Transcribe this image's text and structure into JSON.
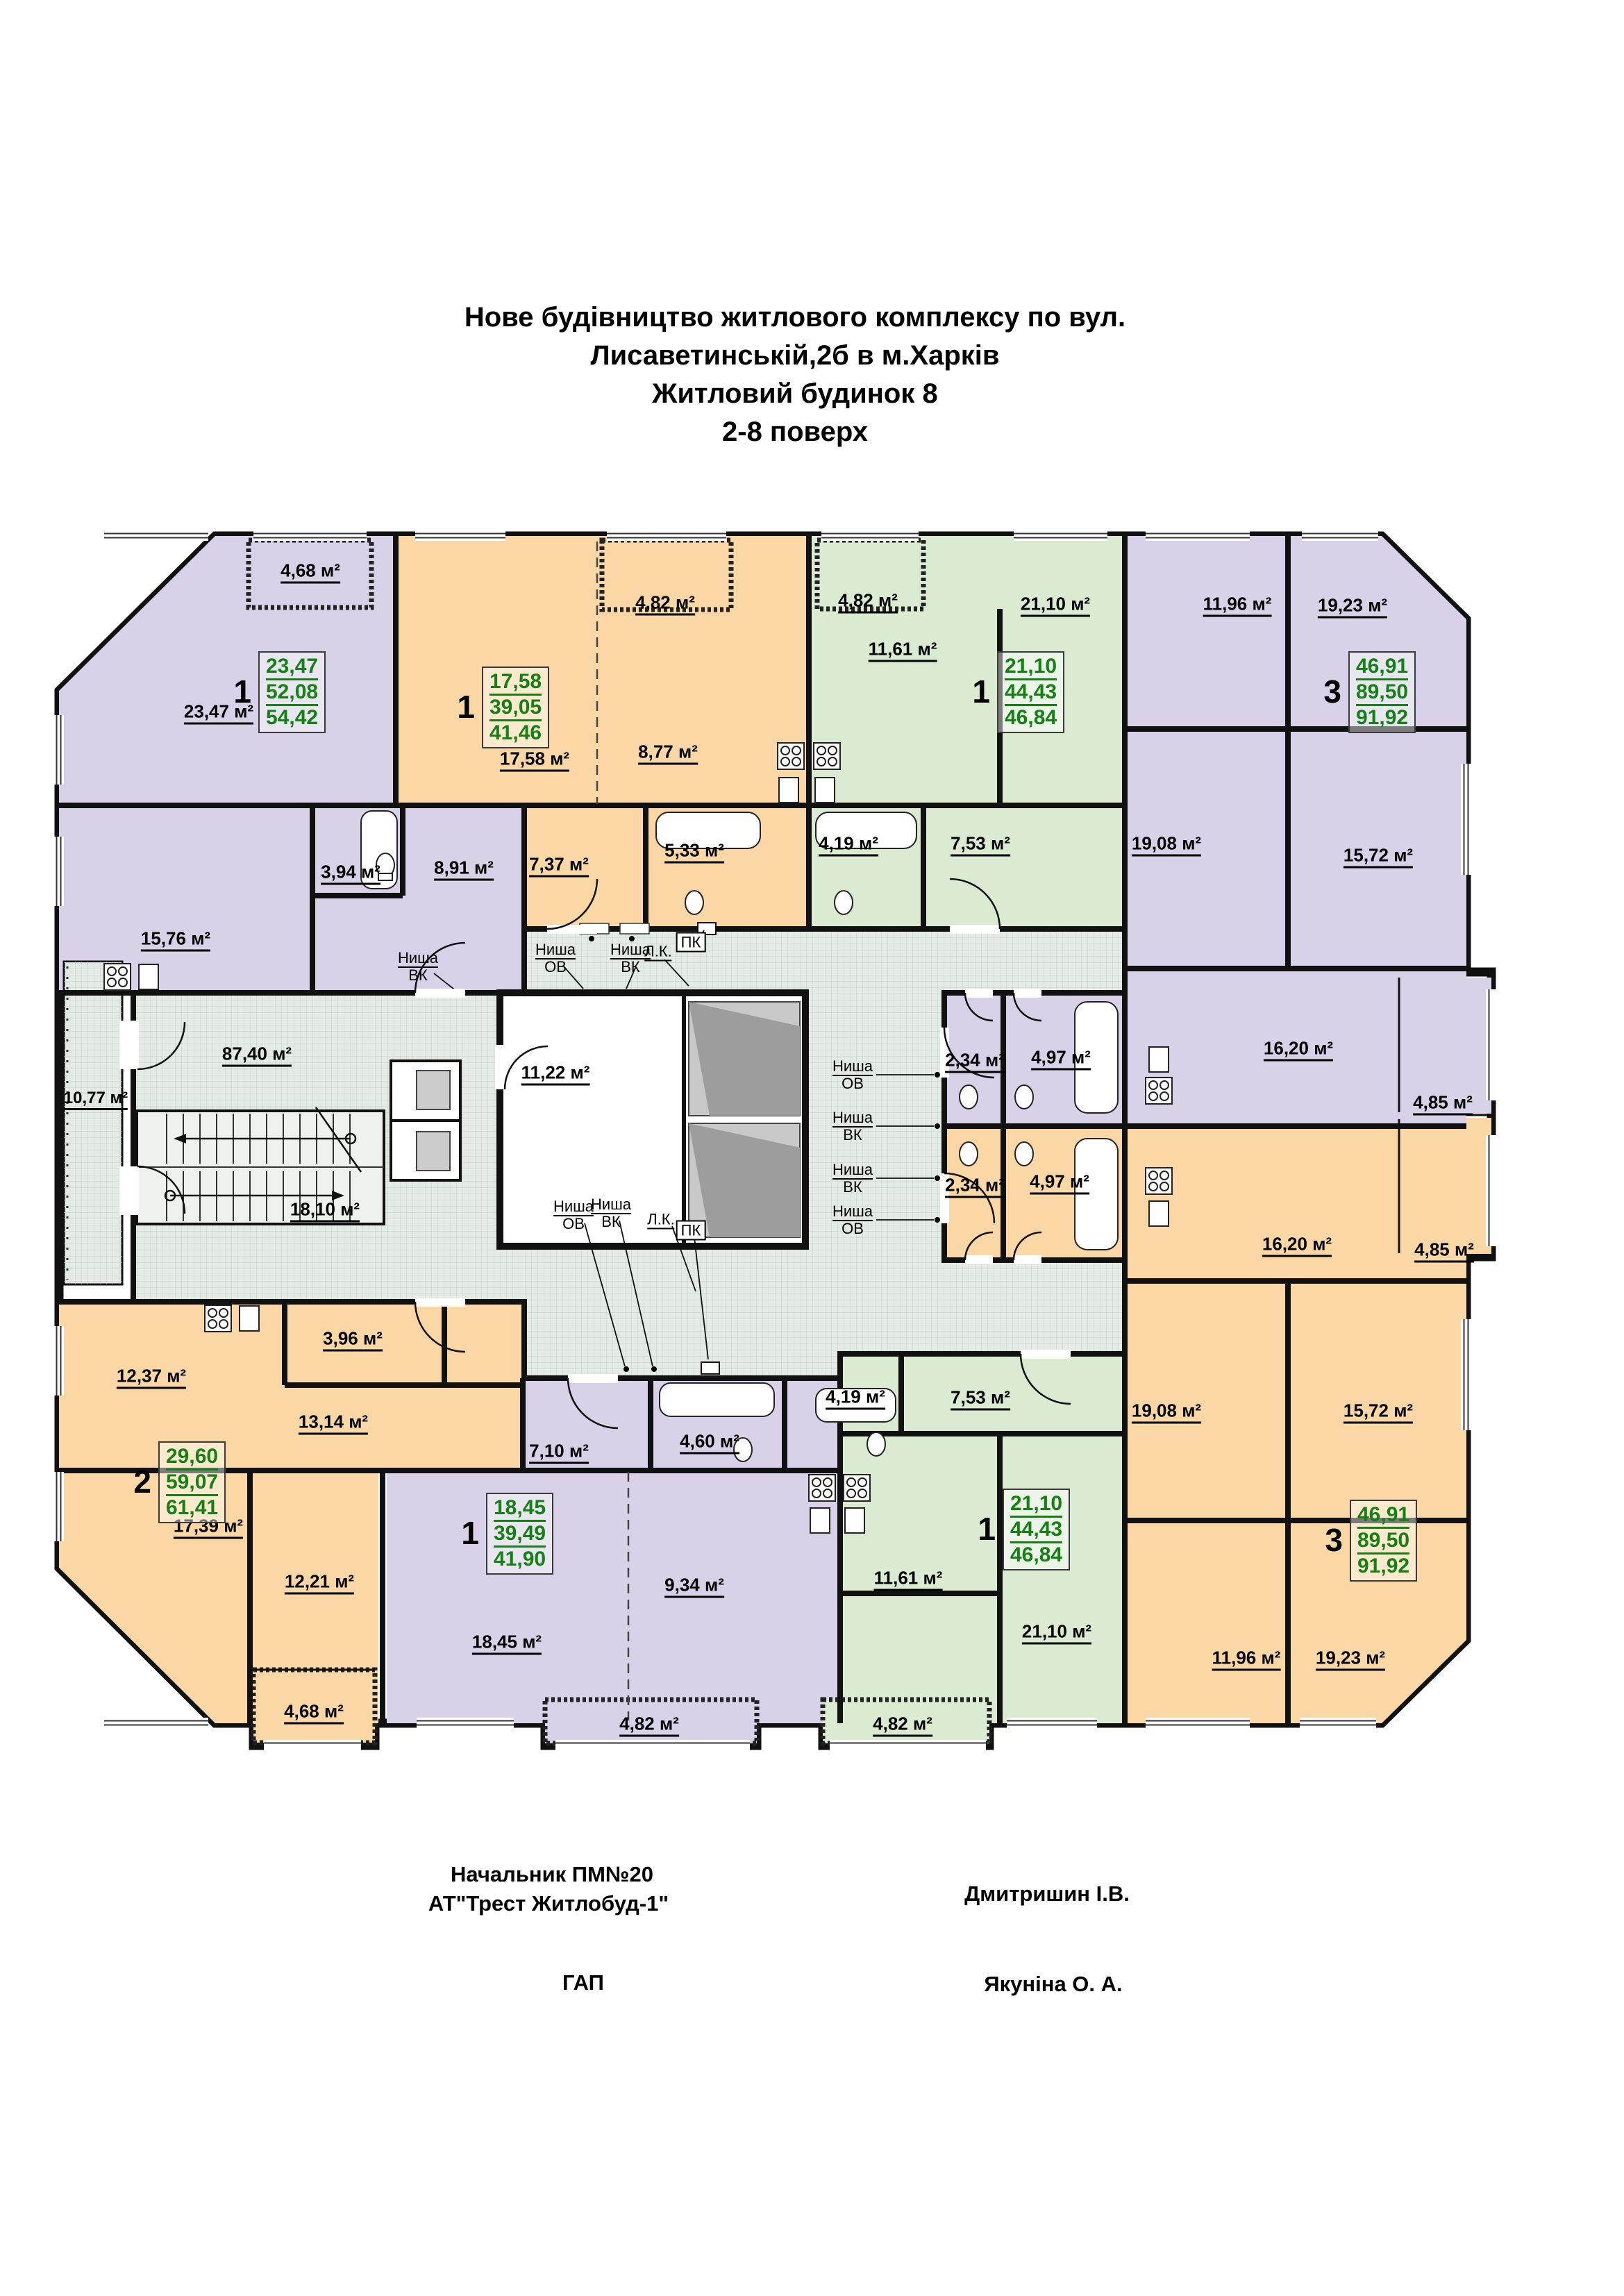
{
  "title": {
    "line1": "Нове будівництво житлового комплексу по вул.",
    "line2": "Лисаветинській,2б в м.Харків",
    "line3": "Житловий будинок 8",
    "line4": "2-8 поверх"
  },
  "plan": {
    "apartments": [
      {
        "position": "top-left",
        "rooms": "1",
        "stats": {
          "living": "23,47",
          "usable": "52,08",
          "total": "54,42"
        }
      },
      {
        "position": "top-middle-left",
        "rooms": "1",
        "stats": {
          "living": "17,58",
          "usable": "39,05",
          "total": "41,46"
        }
      },
      {
        "position": "top-middle-right",
        "rooms": "1",
        "stats": {
          "living": "21,10",
          "usable": "44,43",
          "total": "46,84"
        }
      },
      {
        "position": "top-right",
        "rooms": "3",
        "stats": {
          "living": "46,91",
          "usable": "89,50",
          "total": "91,92"
        }
      },
      {
        "position": "bottom-left",
        "rooms": "2",
        "stats": {
          "living": "29,60",
          "usable": "59,07",
          "total": "61,41"
        }
      },
      {
        "position": "bottom-middle-left",
        "rooms": "1",
        "stats": {
          "living": "18,45",
          "usable": "39,49",
          "total": "41,90"
        }
      },
      {
        "position": "bottom-middle-right",
        "rooms": "1",
        "stats": {
          "living": "21,10",
          "usable": "44,43",
          "total": "46,84"
        }
      },
      {
        "position": "bottom-right",
        "rooms": "3",
        "stats": {
          "living": "46,91",
          "usable": "89,50",
          "total": "91,92"
        }
      }
    ],
    "rooms": [
      {
        "text": "4,68 м²"
      },
      {
        "text": "23,47 м²"
      },
      {
        "text": "15,76 м²"
      },
      {
        "text": "3,94 м²"
      },
      {
        "text": "8,91 м²"
      },
      {
        "text": "4,82 м²"
      },
      {
        "text": "17,58 м²"
      },
      {
        "text": "8,77 м²"
      },
      {
        "text": "7,37 м²"
      },
      {
        "text": "5,33 м²"
      },
      {
        "text": "4,82 м²"
      },
      {
        "text": "11,61 м²"
      },
      {
        "text": "21,10 м²"
      },
      {
        "text": "4,19 м²"
      },
      {
        "text": "7,53 м²"
      },
      {
        "text": "11,96 м²"
      },
      {
        "text": "19,23 м²"
      },
      {
        "text": "19,08 м²"
      },
      {
        "text": "15,72 м²"
      },
      {
        "text": "16,20 м²"
      },
      {
        "text": "2,34 м²"
      },
      {
        "text": "4,97 м²"
      },
      {
        "text": "4,85 м²"
      },
      {
        "text": "2,34 м²"
      },
      {
        "text": "4,97 м²"
      },
      {
        "text": "16,20 м²"
      },
      {
        "text": "4,85 м²"
      },
      {
        "text": "19,08 м²"
      },
      {
        "text": "15,72 м²"
      },
      {
        "text": "11,96 м²"
      },
      {
        "text": "19,23 м²"
      },
      {
        "text": "12,37 м²"
      },
      {
        "text": "3,96 м²"
      },
      {
        "text": "13,14 м²"
      },
      {
        "text": "17,39 м²"
      },
      {
        "text": "12,21 м²"
      },
      {
        "text": "4,68 м²"
      },
      {
        "text": "7,10 м²"
      },
      {
        "text": "4,60 м²"
      },
      {
        "text": "9,34 м²"
      },
      {
        "text": "18,45 м²"
      },
      {
        "text": "4,82 м²"
      },
      {
        "text": "4,19 м²"
      },
      {
        "text": "7,53 м²"
      },
      {
        "text": "11,61 м²"
      },
      {
        "text": "21,10 м²"
      },
      {
        "text": "4,82 м²"
      },
      {
        "text": "87,40 м²"
      },
      {
        "text": "10,77 м²"
      },
      {
        "text": "18,10 м²"
      },
      {
        "text": "11,22 м²"
      }
    ],
    "niches": [
      {
        "line1": "Ниша",
        "line2": "ВК"
      },
      {
        "line1": "Ниша",
        "line2": "ОВ"
      },
      {
        "line1": "Ниша",
        "line2": "ВК"
      },
      {
        "line1": "Л.К."
      },
      {
        "line1": "ПК"
      },
      {
        "line1": "Ниша",
        "line2": "ОВ"
      },
      {
        "line1": "Ниша",
        "line2": "ВК"
      },
      {
        "line1": "Ниша",
        "line2": "ВК"
      },
      {
        "line1": "Ниша",
        "line2": "ОВ"
      },
      {
        "line1": "Ниша",
        "line2": "ОВ"
      },
      {
        "line1": "Ниша",
        "line2": "ВК"
      },
      {
        "line1": "Л.К."
      },
      {
        "line1": "ПК"
      }
    ]
  },
  "signatures": {
    "left_role_line1": "Начальник ПМ№20",
    "left_role_line2": "АТ\"Трест Житлобуд-1\"",
    "right_name1": "Дмитришин І.В.",
    "left_role2": "ГАП",
    "right_name2": "Якуніна О. А."
  },
  "colors": {
    "apartment_purple": "#d8d1e8",
    "apartment_orange": "#fbd7a5",
    "apartment_green": "#daebd2",
    "corridor": "#e4eae6",
    "elevator_shaft": "#c8c8c8",
    "stats_green": "#158015",
    "walls": "#111111"
  }
}
